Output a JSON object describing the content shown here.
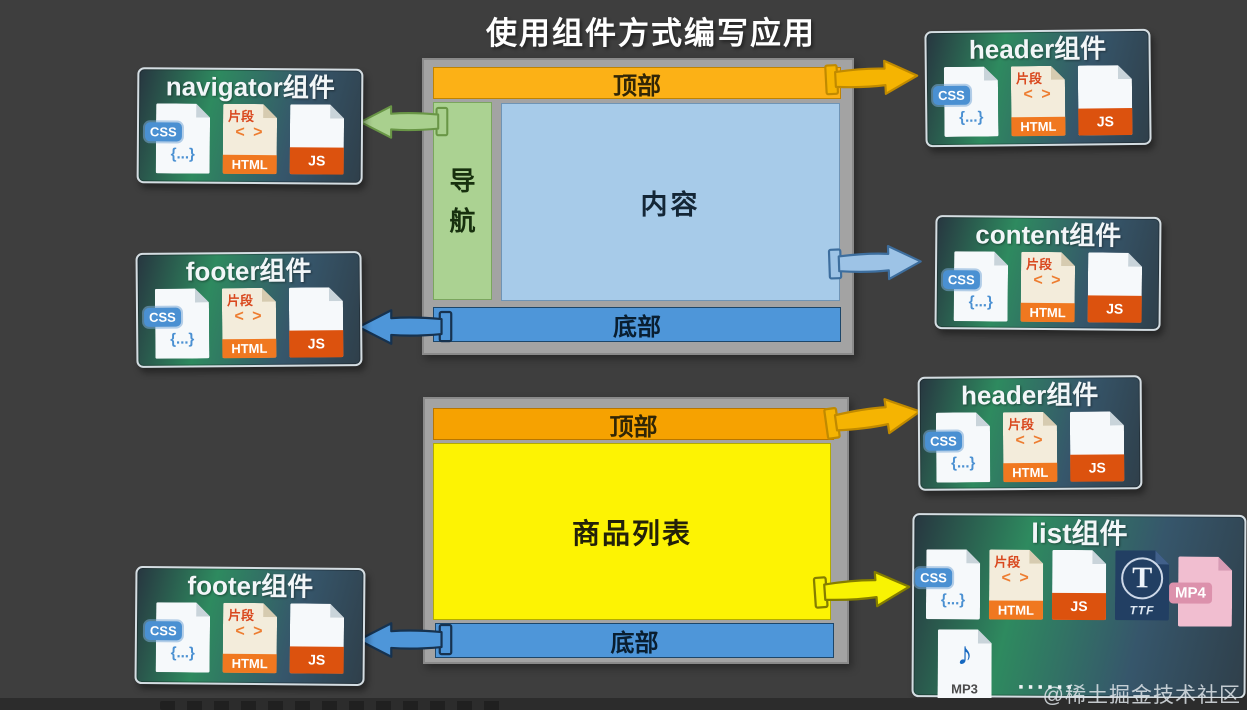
{
  "title": "使用组件方式编写应用",
  "watermark": "@稀土掘金技术社区",
  "wireframes": [
    {
      "top_bar": "顶部",
      "nav": "导航",
      "content": "内容",
      "bottom_bar": "底部"
    },
    {
      "top_bar": "顶部",
      "content": "商品列表",
      "bottom_bar": "底部"
    }
  ],
  "components": [
    {
      "name": "navigator组件"
    },
    {
      "name": "footer组件"
    },
    {
      "name": "footer组件"
    },
    {
      "name": "header组件"
    },
    {
      "name": "content组件"
    },
    {
      "name": "header组件"
    },
    {
      "name": "list组件"
    }
  ],
  "icons": {
    "css": {
      "badge": "CSS",
      "body": "{...}"
    },
    "html": {
      "tag": "片段",
      "code": "< >",
      "label": "HTML"
    },
    "js": {
      "label": "JS"
    },
    "ttf": {
      "letter": "T",
      "label": "TTF"
    },
    "mp4": {
      "label": "MP4"
    },
    "mp3": {
      "note": "♪",
      "label": "MP3"
    },
    "ellipsis": "......"
  },
  "colors": {
    "background": "#3e3e3e",
    "title_text": "#ffffff",
    "wireframe_frame": "#a3a3a3",
    "top_bar_orange": "#fcb116",
    "top_bar_orange2": "#f6a201",
    "nav_green": "#abd292",
    "content_blue": "#a7cbe9",
    "bottom_bar_blue": "#4e96d9",
    "list_yellow": "#fdf303",
    "arrow_green": "#a9d08e",
    "arrow_gold": "#f5b402",
    "arrow_lightblue": "#9dc3e6",
    "arrow_blue": "#4e96d9",
    "arrow_yellow": "#f8f303",
    "card_border": "#d4dde2",
    "card_bg_dark": "#2f3f4a",
    "card_bg_green": "#2e8a5f"
  }
}
